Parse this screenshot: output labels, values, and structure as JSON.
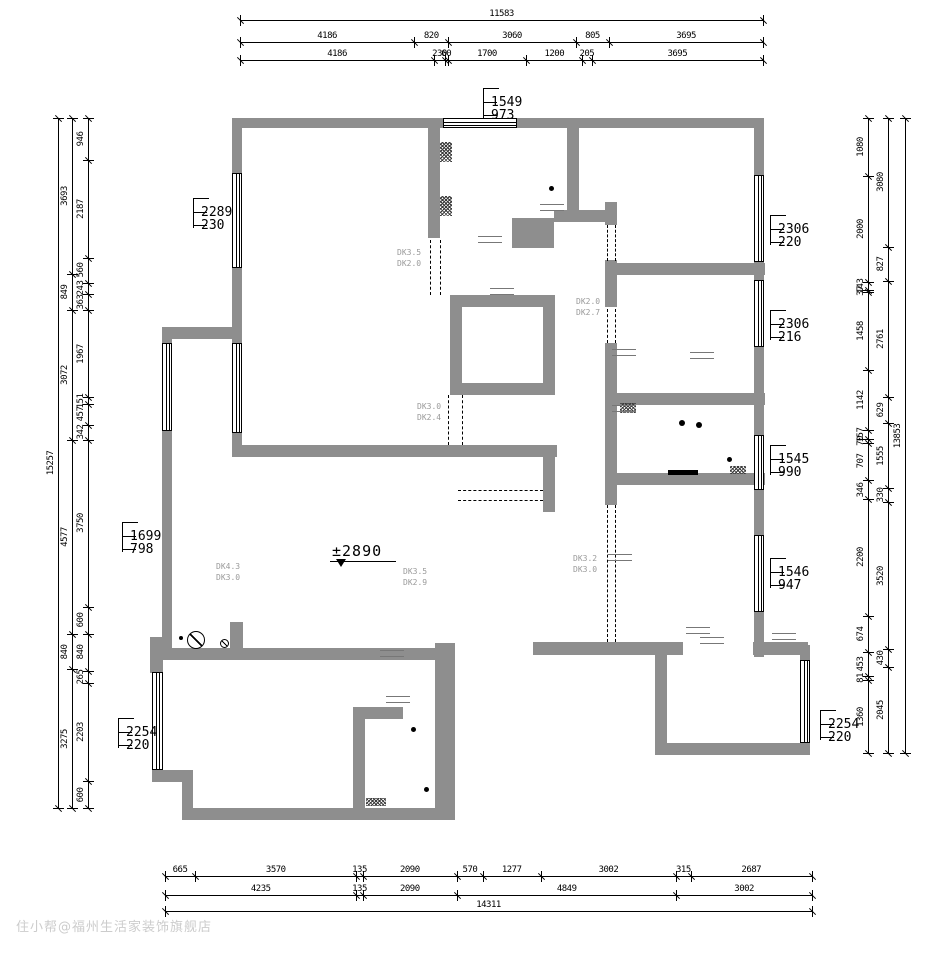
{
  "watermark": {
    "text": "住小帮@福州生活家装饰旗舰店"
  },
  "level_mark": {
    "text": "±2890"
  },
  "bracket_labels": [
    {
      "x": 483,
      "y": 88,
      "line1": "1549",
      "line2": "973"
    },
    {
      "x": 193,
      "y": 198,
      "line1": "2289",
      "line2": "230"
    },
    {
      "x": 770,
      "y": 215,
      "line1": "2306",
      "line2": "220"
    },
    {
      "x": 770,
      "y": 310,
      "line1": "2306",
      "line2": "216"
    },
    {
      "x": 770,
      "y": 445,
      "line1": "1545",
      "line2": "990"
    },
    {
      "x": 770,
      "y": 558,
      "line1": "1546",
      "line2": "947"
    },
    {
      "x": 820,
      "y": 710,
      "line1": "2254",
      "line2": "220"
    },
    {
      "x": 122,
      "y": 522,
      "line1": "1699",
      "line2": "798"
    },
    {
      "x": 118,
      "y": 718,
      "line1": "2254",
      "line2": "220"
    }
  ],
  "faint_labels": [
    {
      "x": 397,
      "y": 248,
      "line1": "DK3.5",
      "line2": "DK2.0"
    },
    {
      "x": 576,
      "y": 297,
      "line1": "DK2.0",
      "line2": "DK2.7"
    },
    {
      "x": 417,
      "y": 402,
      "line1": "DK3.0",
      "line2": "DK2.4"
    },
    {
      "x": 216,
      "y": 562,
      "line1": "DK4.3",
      "line2": "DK3.0"
    },
    {
      "x": 403,
      "y": 567,
      "line1": "DK3.5",
      "line2": "DK2.9"
    },
    {
      "x": 573,
      "y": 554,
      "line1": "DK3.2",
      "line2": "DK3.0"
    }
  ],
  "dims": {
    "h_chains": [
      {
        "y": 20,
        "x1": 240,
        "x2": 763,
        "values": [
          11583
        ]
      },
      {
        "y": 42,
        "x1": 240,
        "x2": 763,
        "values": [
          4186,
          820,
          3060,
          805,
          3695
        ]
      },
      {
        "y": 60,
        "x1": 240,
        "x2": 763,
        "values": [
          4186,
          230,
          60,
          1700,
          1200,
          205,
          3695
        ]
      },
      {
        "y": 876,
        "x1": 165,
        "x2": 812,
        "values": [
          665,
          3570,
          135,
          2090,
          570,
          1277,
          3002,
          315,
          2687
        ]
      },
      {
        "y": 895,
        "x1": 165,
        "x2": 812,
        "values": [
          4235,
          135,
          2090,
          4849,
          3002
        ]
      },
      {
        "y": 911,
        "x1": 165,
        "x2": 812,
        "values": [
          14311
        ]
      }
    ],
    "v_chains": [
      {
        "x": 58,
        "y1": 118,
        "y2": 808,
        "values": [
          15257
        ]
      },
      {
        "x": 72,
        "y1": 118,
        "y2": 808,
        "values": [
          3693,
          849,
          3072,
          4577,
          840,
          3275
        ]
      },
      {
        "x": 88,
        "y1": 118,
        "y2": 808,
        "values": [
          946,
          2187,
          560,
          243,
          363,
          1967,
          151,
          457,
          342,
          3750,
          600,
          840,
          265,
          2203,
          600
        ]
      },
      {
        "x": 868,
        "y1": 118,
        "y2": 753,
        "values": [
          1080,
          2000,
          143,
          37,
          1458,
          1142,
          157,
          70,
          707,
          346,
          2200,
          674,
          453,
          81,
          1360
        ]
      },
      {
        "x": 888,
        "y1": 118,
        "y2": 753,
        "values": [
          3080,
          827,
          2761,
          629,
          1555,
          330,
          3520,
          430,
          2045
        ]
      },
      {
        "x": 905,
        "y1": 118,
        "y2": 753,
        "values": [
          13853
        ]
      }
    ]
  },
  "plan": {
    "wall_color": "#8e8e8e",
    "walls": [
      [
        232,
        118,
        211,
        10
      ],
      [
        517,
        118,
        247,
        10
      ],
      [
        232,
        128,
        10,
        45
      ],
      [
        232,
        268,
        10,
        34
      ],
      [
        428,
        128,
        12,
        110
      ],
      [
        567,
        128,
        12,
        88
      ],
      [
        512,
        218,
        42,
        30
      ],
      [
        554,
        210,
        63,
        12
      ],
      [
        754,
        128,
        10,
        47
      ],
      [
        754,
        262,
        10,
        18
      ],
      [
        754,
        347,
        10,
        88
      ],
      [
        754,
        490,
        10,
        45
      ],
      [
        754,
        612,
        10,
        45
      ],
      [
        605,
        202,
        12,
        23
      ],
      [
        605,
        260,
        12,
        47
      ],
      [
        605,
        343,
        12,
        130
      ],
      [
        605,
        473,
        12,
        32
      ],
      [
        605,
        263,
        160,
        12
      ],
      [
        605,
        393,
        160,
        12
      ],
      [
        605,
        473,
        160,
        12
      ],
      [
        533,
        642,
        150,
        13
      ],
      [
        753,
        642,
        55,
        13
      ],
      [
        655,
        655,
        12,
        100
      ],
      [
        655,
        743,
        155,
        12
      ],
      [
        800,
        645,
        10,
        15
      ],
      [
        800,
        743,
        10,
        12
      ],
      [
        152,
        648,
        290,
        12
      ],
      [
        150,
        637,
        13,
        36
      ],
      [
        162,
        327,
        10,
        16
      ],
      [
        162,
        431,
        10,
        217
      ],
      [
        162,
        327,
        70,
        12
      ],
      [
        232,
        302,
        10,
        41
      ],
      [
        232,
        433,
        10,
        24
      ],
      [
        232,
        445,
        325,
        12
      ],
      [
        450,
        295,
        12,
        98
      ],
      [
        450,
        295,
        105,
        12
      ],
      [
        543,
        295,
        12,
        100
      ],
      [
        450,
        383,
        105,
        12
      ],
      [
        543,
        457,
        12,
        55
      ],
      [
        230,
        622,
        13,
        26
      ],
      [
        152,
        660,
        11,
        12
      ],
      [
        152,
        770,
        41,
        12
      ],
      [
        182,
        782,
        11,
        26
      ],
      [
        182,
        808,
        273,
        12
      ],
      [
        353,
        707,
        12,
        101
      ],
      [
        353,
        707,
        50,
        12
      ],
      [
        435,
        643,
        20,
        177
      ]
    ],
    "windows": [
      {
        "r": [
          443,
          118,
          74,
          10
        ],
        "dir": "h"
      },
      {
        "r": [
          232,
          173,
          10,
          95
        ],
        "dir": "v"
      },
      {
        "r": [
          162,
          343,
          10,
          88
        ],
        "dir": "v"
      },
      {
        "r": [
          232,
          343,
          10,
          90
        ],
        "dir": "v"
      },
      {
        "r": [
          152,
          672,
          11,
          98
        ],
        "dir": "v"
      },
      {
        "r": [
          754,
          175,
          10,
          87
        ],
        "dir": "v"
      },
      {
        "r": [
          754,
          280,
          10,
          67
        ],
        "dir": "v"
      },
      {
        "r": [
          754,
          435,
          10,
          55
        ],
        "dir": "v"
      },
      {
        "r": [
          754,
          535,
          10,
          77
        ],
        "dir": "v"
      },
      {
        "r": [
          800,
          660,
          10,
          83
        ],
        "dir": "v"
      }
    ],
    "dashes": [
      [
        430,
        240,
        55,
        "v"
      ],
      [
        440,
        240,
        55,
        "v"
      ],
      [
        448,
        395,
        50,
        "v"
      ],
      [
        462,
        395,
        50,
        "v"
      ],
      [
        607,
        225,
        36,
        "v"
      ],
      [
        615,
        225,
        36,
        "v"
      ],
      [
        607,
        309,
        34,
        "v"
      ],
      [
        615,
        309,
        34,
        "v"
      ],
      [
        607,
        505,
        137,
        "v"
      ],
      [
        615,
        505,
        137,
        "v"
      ],
      [
        458,
        490,
        85,
        "h"
      ],
      [
        458,
        500,
        85,
        "h"
      ]
    ],
    "hatches": [
      [
        440,
        142,
        12,
        20
      ],
      [
        440,
        196,
        12,
        20
      ],
      [
        620,
        403,
        16,
        10
      ],
      [
        366,
        798,
        20,
        8
      ],
      [
        730,
        466,
        16,
        8
      ]
    ],
    "dots": [
      [
        549,
        186,
        5
      ],
      [
        179,
        636,
        4
      ],
      [
        679,
        420,
        6
      ],
      [
        696,
        422,
        6
      ],
      [
        727,
        457,
        5
      ],
      [
        411,
        727,
        5
      ],
      [
        424,
        787,
        5
      ]
    ],
    "bars": [
      [
        668,
        470,
        30,
        5
      ]
    ],
    "circles": [
      [
        187,
        631,
        18
      ],
      [
        220,
        639,
        9
      ]
    ],
    "tick_marks": [
      [
        478,
        236
      ],
      [
        490,
        288
      ],
      [
        612,
        349
      ],
      [
        612,
        405
      ],
      [
        686,
        627
      ],
      [
        772,
        633
      ],
      [
        380,
        650
      ],
      [
        386,
        696
      ],
      [
        540,
        204
      ],
      [
        608,
        554
      ],
      [
        690,
        352
      ],
      [
        700,
        637
      ]
    ]
  }
}
